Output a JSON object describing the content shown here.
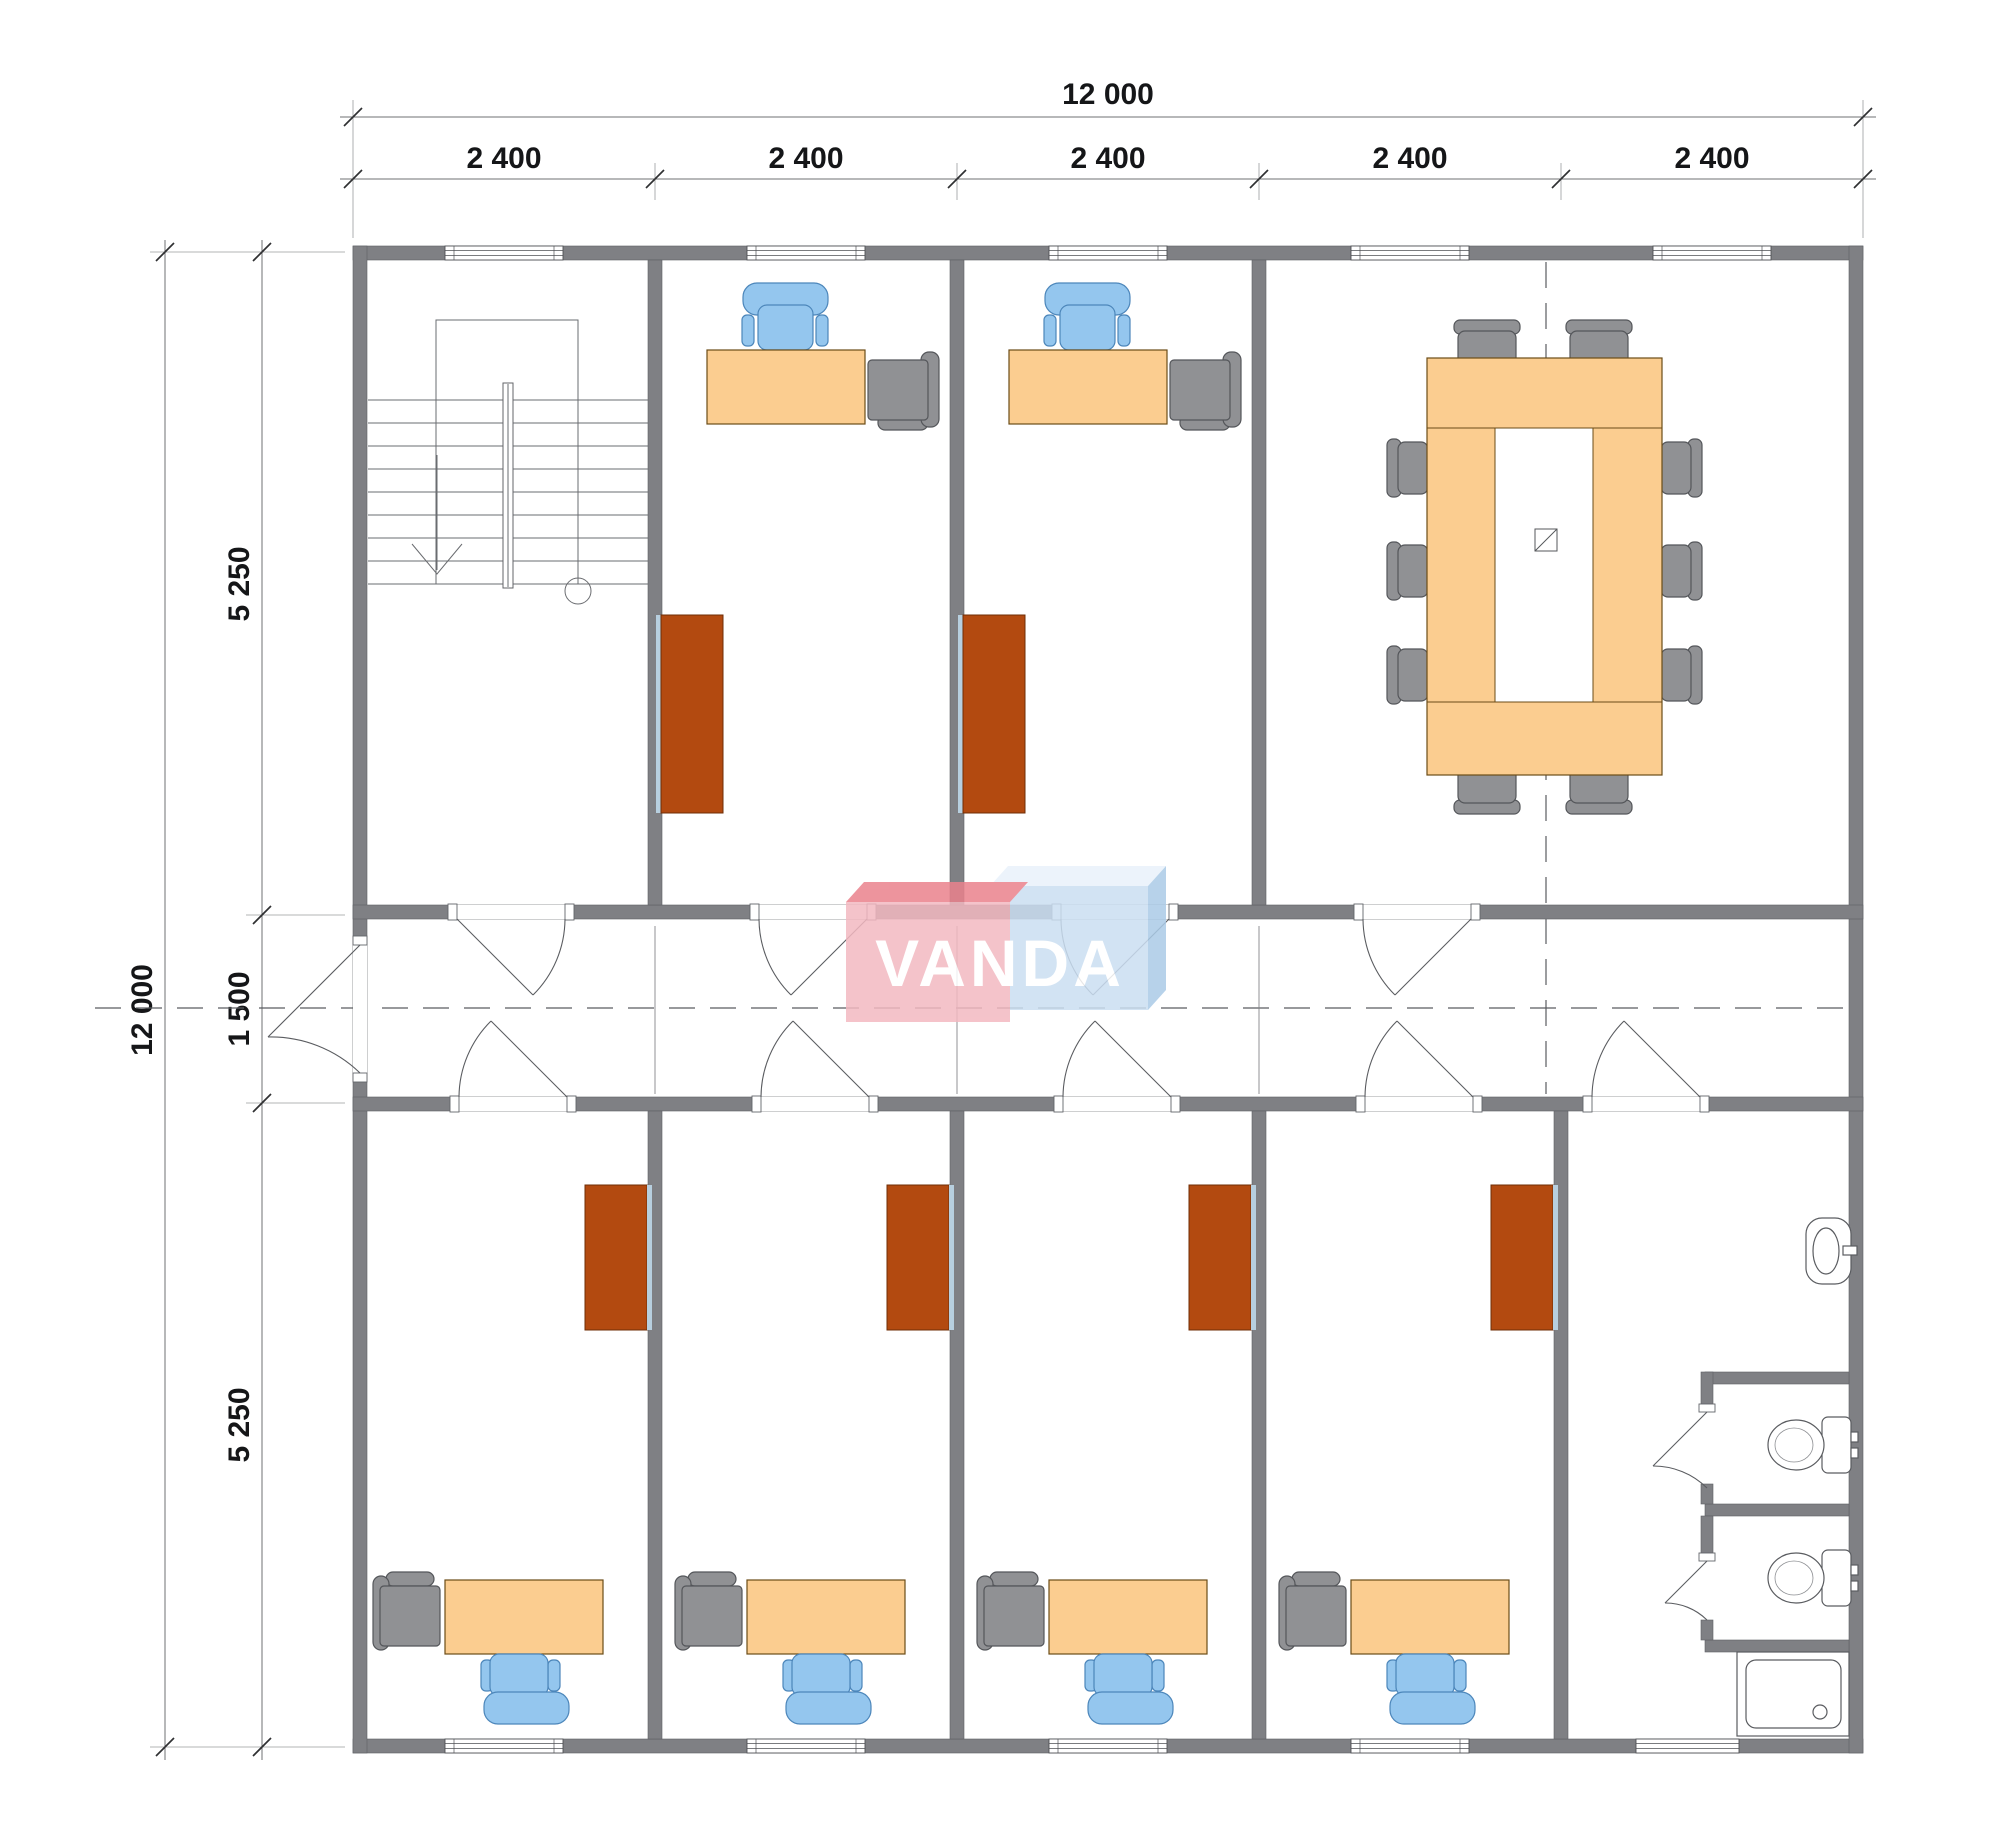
{
  "page": {
    "type": "architectural-floor-plan",
    "content": "office building storey plan with furniture"
  },
  "dimensions": {
    "top": {
      "total": "12 000",
      "segments": [
        "2 400",
        "2 400",
        "2 400",
        "2 400",
        "2 400"
      ]
    },
    "left": {
      "total": "12 000",
      "segments": [
        "5 250",
        "1 500",
        "5 250"
      ]
    }
  },
  "logo": {
    "text": "VANDA"
  },
  "palette": {
    "wall": "#7f8084",
    "wall_edge": "#5e6064",
    "dim_line": "#6f7073",
    "dim_ext": "#9a9b9d",
    "dim_text": "#151618",
    "axis": "#5a5c60",
    "stair": "#6a6c70",
    "desk": "#fbcd90",
    "desk_border": "#6b4c17",
    "chair_blue": "#94c6ee",
    "chair_blue_border": "#4c86ba",
    "furniture_gray": "#909194",
    "furniture_gray_border": "#54565a",
    "cabinet": "#b34a10",
    "cabinet_border": "#6f2d06",
    "cabinet_strip": "#b7cfdf",
    "fixture": "#5a5c60",
    "logo_pink": "#f3b9c1",
    "logo_pink_top": "#ea828d",
    "logo_blue": "#cbdff2",
    "logo_blue_top": "#e9f2fb",
    "logo_blue_side": "#abcbe7"
  }
}
